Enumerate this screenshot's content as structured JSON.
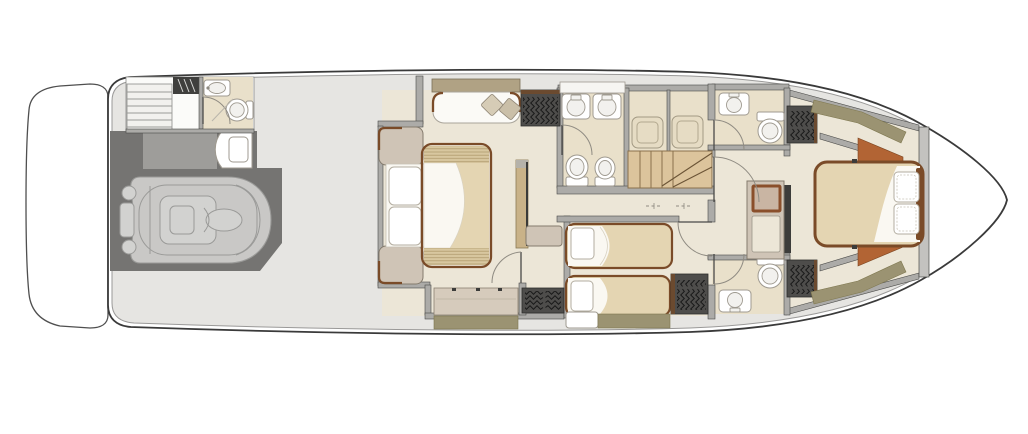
{
  "meta": {
    "title": "Yacht lower deck floor plan",
    "diagram_type": "floor-plan",
    "orientation": "bow-right"
  },
  "palette": {
    "page_bg": "#ffffff",
    "hull_fill": "#ffffff",
    "hull_outline": "#3a3a3a",
    "platform_outline": "#4f4f4f",
    "deck_fill": "#e6e5e2",
    "deck_edge": "#9a9998",
    "garage_fill": "#757472",
    "garage_notch": "#9e9d9a",
    "tender_fill": "#c9c8c6",
    "tender_sub": "#d2d2d0",
    "tender_line": "#9a9a98",
    "floor_cream": "#ece6d7",
    "floor_beige": "#e9e0ca",
    "wall_fill": "#acaba8",
    "wall_edge": "#4a4a48",
    "slab_dark": "#3c3c3a",
    "bulkhead_fill": "#c3c2bf",
    "wood_trim": "#7a4b28",
    "shelf_fill": "#b0a284",
    "linen_white": "#faf8f2",
    "mattress_tan": "#e4d5b2",
    "slat_tan": "#d8c79f",
    "slat_line": "#b09a6e",
    "taupe_cabinet": "#cfc4b6",
    "cabinet_edge": "#847b6d",
    "olive_panel": "#9b9372",
    "olive_edge": "#7e774f",
    "rust_panel": "#b26434",
    "rust_edge": "#7c4520",
    "wardrobe_dark": "#4e4d4b",
    "wardrobe_trim": "#6b4a2f",
    "stair_fill": "#dcc49c",
    "stair_line": "#8a714c",
    "fixture_inner": "#f2f1ee",
    "fixture_outline": "#9f9a90",
    "pillow_edge": "#b3ada0",
    "door_arc": "#8f8b82",
    "tv_frame": "#8a4f2b"
  },
  "regions": {
    "swim_platform": {
      "label": "swim platform"
    },
    "tender_garage": {
      "label": "tender garage",
      "fixtures": [
        "tender-dinghy",
        "outboard-engine"
      ]
    },
    "crew_quarters": {
      "label": "crew quarters",
      "fixtures": [
        "crew-stairs",
        "companionway-steps",
        "sink",
        "toilet",
        "shower"
      ]
    },
    "vip_cabin": {
      "label": "vip cabin midship",
      "fixtures": [
        "double-bed",
        "pillows",
        "nightstand-aft-port",
        "nightstand-aft-starboard",
        "sofa",
        "scatter-cushions",
        "hanging-locker",
        "tv-panel",
        "bench",
        "dresser"
      ]
    },
    "vip_bathroom": {
      "label": "bathroom twin sinks",
      "fixtures": [
        "vanity-counter",
        "sink",
        "sink",
        "toilet",
        "bidet"
      ]
    },
    "shower_rooms": {
      "label": "shower rooms",
      "fixtures": [
        "shower-tray",
        "shower-tray"
      ]
    },
    "staircase": {
      "label": "winder staircase to main deck"
    },
    "corridor": {
      "label": "lower lobby corridor"
    },
    "twin_cabin": {
      "label": "twin cabin",
      "fixtures": [
        "single-bed",
        "single-bed",
        "hanging-locker",
        "step-locker"
      ]
    },
    "head_forward_port": {
      "label": "forward head port",
      "fixtures": [
        "sink",
        "toilet"
      ]
    },
    "head_forward_starboard": {
      "label": "forward head starboard",
      "fixtures": [
        "sink",
        "toilet"
      ]
    },
    "master_vestibule": {
      "label": "master vestibule",
      "fixtures": [
        "tv-cabinet",
        "drawer-unit",
        "hanging-locker",
        "hanging-locker"
      ]
    },
    "master_cabin": {
      "label": "master cabin forward",
      "fixtures": [
        "double-bed",
        "pillows",
        "hull-side-panels",
        "side-cabinets"
      ]
    },
    "bow": {
      "label": "bow"
    }
  }
}
